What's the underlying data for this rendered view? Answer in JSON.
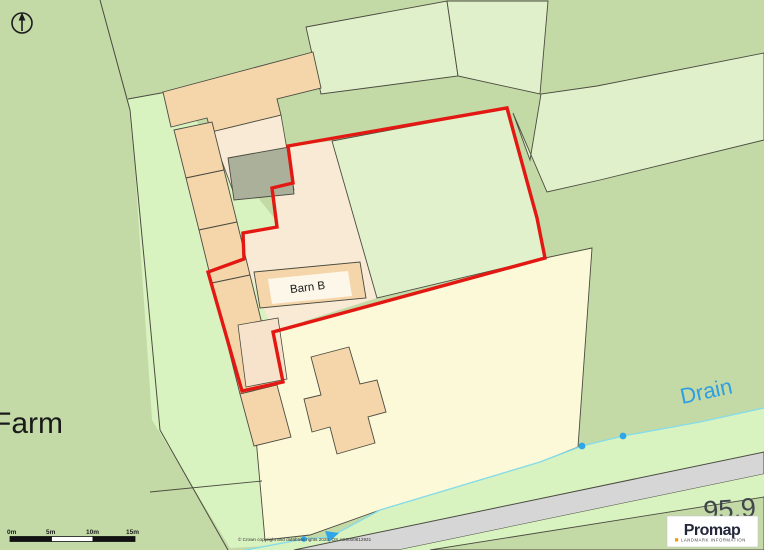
{
  "map": {
    "labels": {
      "farm": "Farm",
      "barn_b": "Barn B",
      "drain": "Drain",
      "spot_height": "95.9"
    },
    "copyright": "© Crown copyright and database rights 2025. OS AC0000812931",
    "scale_bar": {
      "labels": [
        "0m",
        "5m",
        "10m",
        "15m"
      ]
    },
    "icons": {
      "compass": "north-arrow"
    }
  },
  "branding": {
    "wordmark": "Promap",
    "tagline": "LANDMARK INFORMATION"
  },
  "colors": {
    "background": "#c3d9a6",
    "parcel_green": "#dff0ca",
    "track_green": "#d8f2c0",
    "field_green": "#e0f1cc",
    "parcel_yellow": "#fbf9d8",
    "cream": "#f8ead4",
    "cream_rect": "#f7e3cc",
    "building_peach": "#f5d6ab",
    "building_gray": "#abb09b",
    "road_gray": "#d6d6d6",
    "boundary_red": "#e31812",
    "drain_cyan": "#84dcea",
    "drain_dot_blue": "#2ea6e8",
    "drain_label_blue": "#2d9fe2",
    "outline_dark": "#4b4b40",
    "label_black": "#1a1a1a",
    "spot_height_gray": "#41464c",
    "promap_navy": "#23273a",
    "landmark_orange": "#f09a08",
    "label_box_white": "#fdf7ea",
    "logo_box_white": "#ffffff"
  }
}
